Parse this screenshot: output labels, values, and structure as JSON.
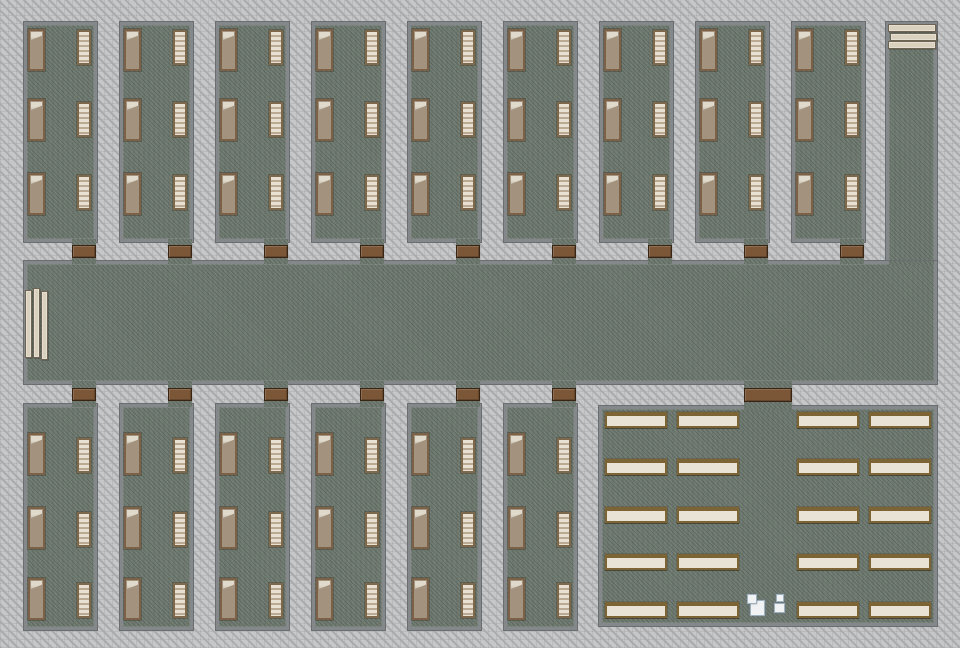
{
  "scene": {
    "description": "top-down tile floor plan: dormitory rooms with beds and shelves, central corridor with benches, right service corridor, canteen with dining tables and sinks",
    "canvas": {
      "width": 960,
      "height": 648
    }
  },
  "colors": {
    "bg": "#c6c7c9",
    "bgStripe": "#a9abad",
    "wall": "#85888b",
    "wallDark": "#6b6e71",
    "floor": "#6e7970",
    "door": "#7b5637",
    "doorDark": "#382413",
    "bedFrame": "#7a6148",
    "bedMattress": "#a3927d",
    "bedPillow": "#e0dacd",
    "shelfFrame": "#7e684c",
    "shelfLight": "#e8e1d3",
    "shelfDark": "#b9aa91",
    "bench": "#d9d0bd",
    "benchBorder": "#6e6453",
    "tableTop": "#e9e3d6",
    "tableFrame": "#7d6434",
    "sink": "#f1f2f3",
    "sinkBorder": "#9fb0bd"
  },
  "objects": {
    "bed_icon": "bed",
    "shelf_icon": "slatted-shelf",
    "door_icon": "door-mat",
    "bench_icon": "bench",
    "table_icon": "dining-table",
    "sink_icon": "sink-box"
  },
  "layout": {
    "mainCorridor": {
      "x": 24,
      "y": 261,
      "w": 913,
      "h": 123
    },
    "rightCorridor": {
      "x": 886,
      "y": 22,
      "w": 51,
      "h": 362
    },
    "junctionPatch": {
      "x": 889,
      "y": 261,
      "w": 45,
      "h": 4
    },
    "topRooms": {
      "count": 9,
      "x0": 24,
      "pitch": 96,
      "y": 22,
      "w": 73,
      "h": 220,
      "beds": {
        "x": 4,
        "w": 17,
        "h": 42,
        "ys": [
          7,
          77,
          151
        ]
      },
      "shelves": {
        "x": 53,
        "w": 14,
        "h": 35,
        "ys": [
          8,
          80,
          153
        ]
      },
      "doorDx": 48,
      "doorW": 24,
      "door": {
        "y": 245,
        "h": 13,
        "patchY": 239,
        "patchH": 25
      }
    },
    "bottomRooms": {
      "count": 6,
      "x0": 24,
      "pitch": 96,
      "y": 404,
      "w": 73,
      "h": 226,
      "beds": {
        "x": 4,
        "w": 17,
        "h": 42,
        "ys": [
          29,
          103,
          174
        ]
      },
      "shelves": {
        "x": 53,
        "w": 14,
        "h": 35,
        "ys": [
          34,
          108,
          179
        ]
      },
      "doorDx": 48,
      "doorW": 24,
      "door": {
        "y": 388,
        "h": 13,
        "patchY": 381,
        "patchH": 26
      }
    },
    "canteen": {
      "x": 599,
      "y": 406,
      "w": 338,
      "h": 220,
      "door": {
        "x": 744,
        "y": 388,
        "w": 48,
        "h": 14,
        "patchY": 381,
        "patchH": 29
      },
      "tableCols": [
        605,
        677,
        797,
        869
      ],
      "tableRows": [
        412,
        459,
        507,
        554,
        602
      ],
      "tableW": 62,
      "tableH": 16,
      "sinks": [
        {
          "x": 750,
          "y": 600,
          "w": 15,
          "h": 16,
          "capDx": -3,
          "capDy": -6,
          "capW": 10,
          "capH": 10
        },
        {
          "x": 774,
          "y": 603,
          "w": 11,
          "h": 10,
          "capDx": 2,
          "capDy": -9,
          "capW": 8,
          "capH": 8
        }
      ]
    },
    "benchesLeft": [
      {
        "x": 25,
        "y": 290,
        "w": 7,
        "h": 68
      },
      {
        "x": 33,
        "y": 288,
        "w": 7,
        "h": 70
      },
      {
        "x": 41,
        "y": 291,
        "w": 7,
        "h": 69
      }
    ],
    "benchesTopRight": [
      {
        "x": 888,
        "y": 24,
        "w": 48,
        "h": 8
      },
      {
        "x": 890,
        "y": 33,
        "w": 47,
        "h": 8
      },
      {
        "x": 888,
        "y": 41,
        "w": 48,
        "h": 8
      }
    ]
  }
}
